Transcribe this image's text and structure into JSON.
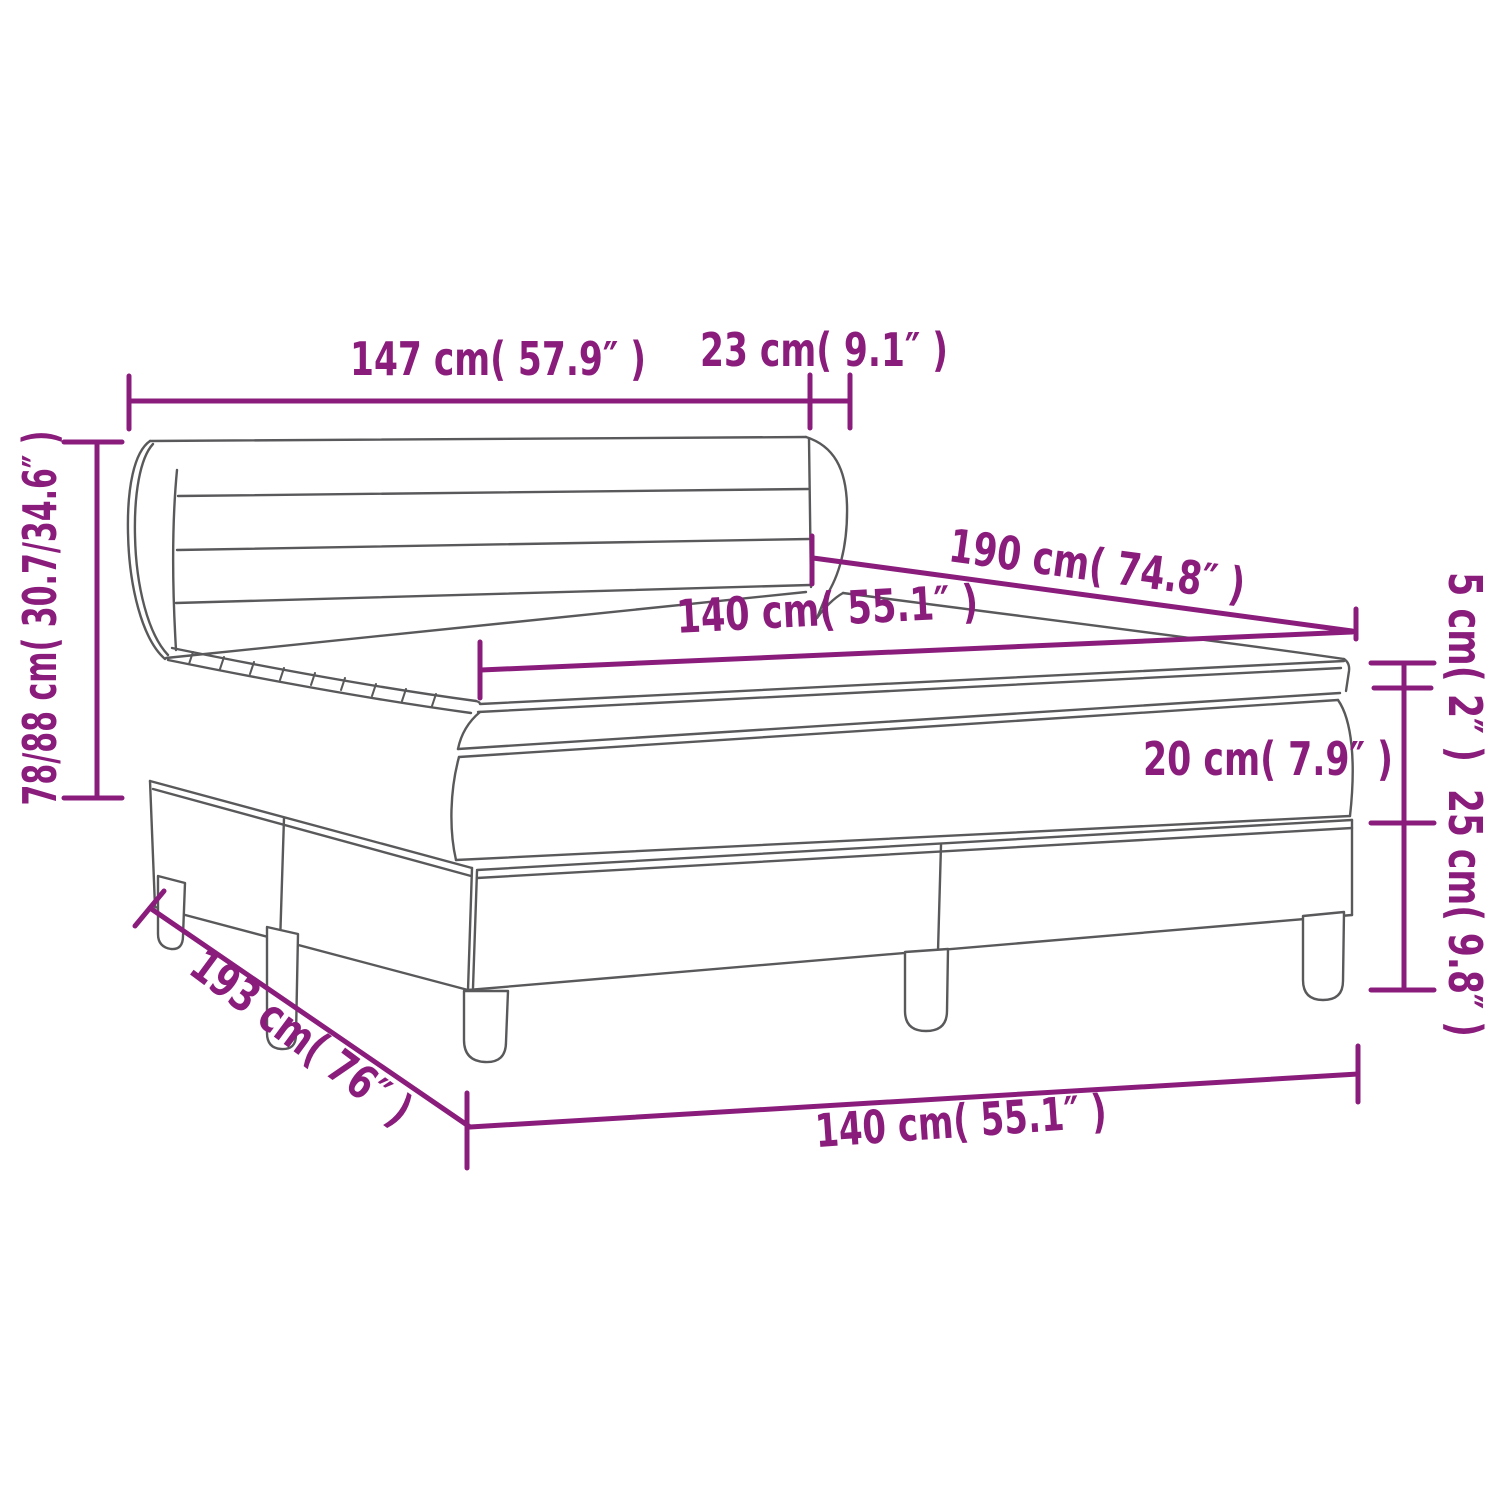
{
  "diagram": {
    "type": "furniture-dimension-diagram",
    "subject": "box-spring-bed-with-headboard-and-mattress-topper"
  },
  "dimensions": {
    "headboard_width": "147 cm( 57.9″ )",
    "headboard_depth": "23 cm( 9.1″ )",
    "total_height_range": "78/88 cm( 30.7/34.6″ )",
    "bed_length": "190 cm( 74.8″ )",
    "mattress_width_top": "140 cm( 55.1″ )",
    "topper_height": "5 cm( 2″ )",
    "mattress_height": "20 cm( 7.9″ )",
    "base_height": "25 cm( 9.8″ )",
    "total_depth": "193 cm( 76″ )",
    "base_width_bottom": "140 cm( 55.1″ )"
  },
  "colors": {
    "dimension": "#8A1C7C",
    "outline": "#59595B",
    "background": "#FFFFFF"
  }
}
